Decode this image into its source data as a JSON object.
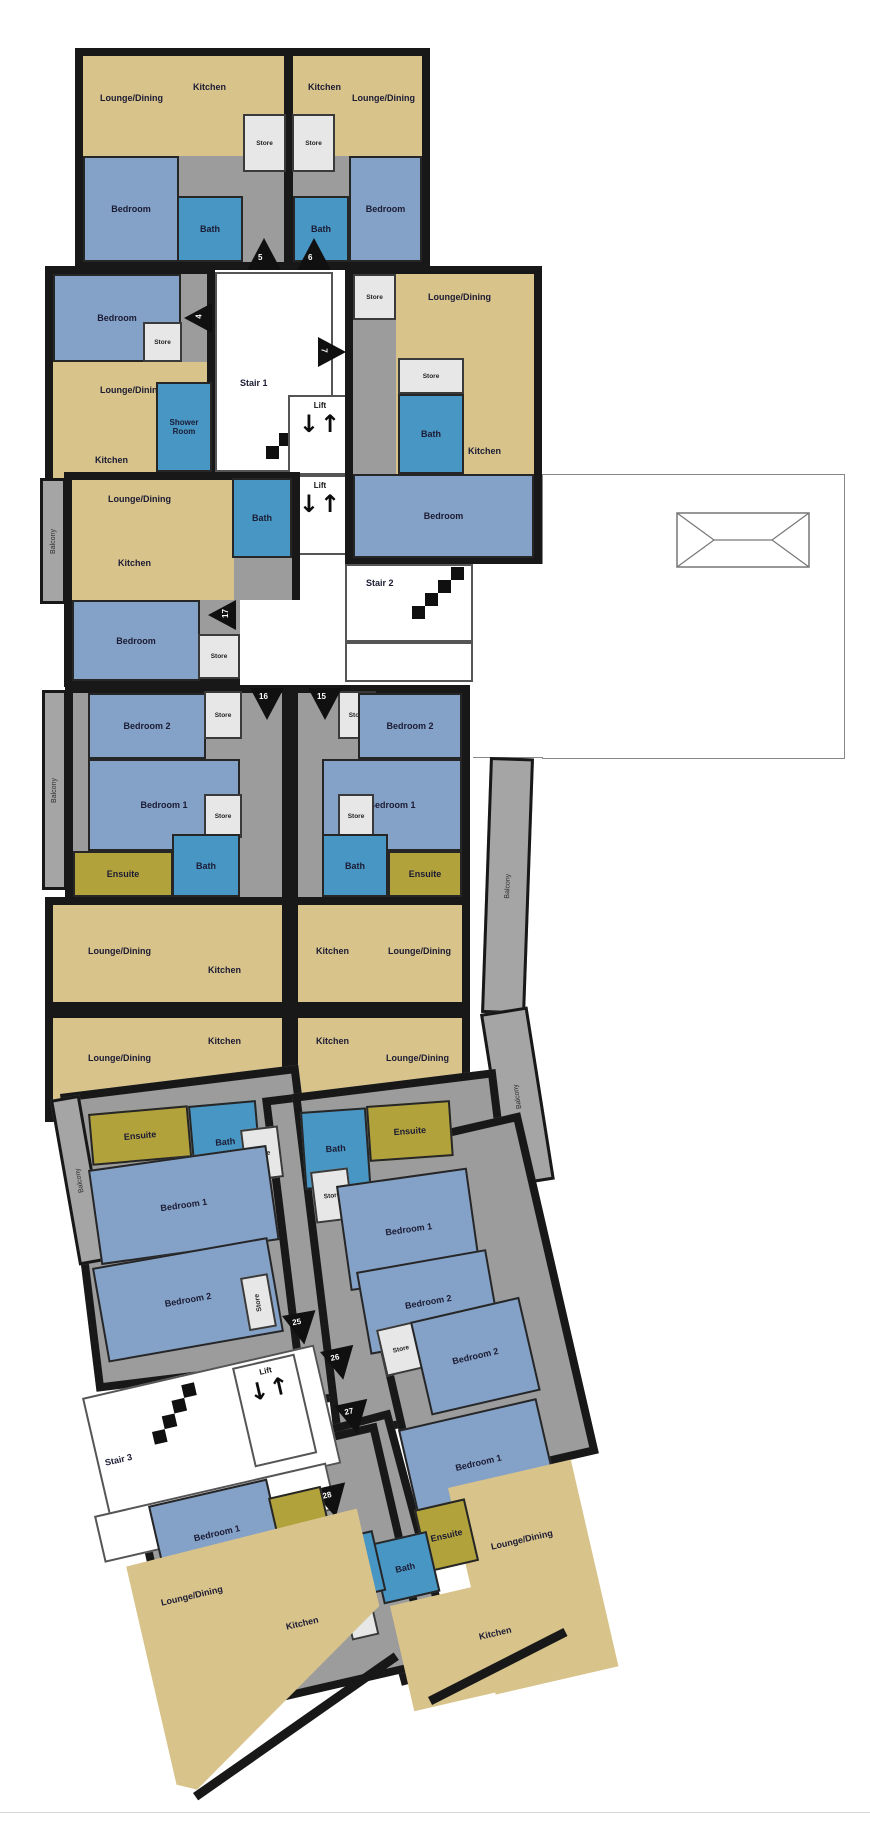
{
  "labels": {
    "lounge_dining": "Lounge/Dining",
    "kitchen": "Kitchen",
    "bedroom": "Bedroom",
    "bedroom1": "Bedroom 1",
    "bedroom2": "Bedroom 2",
    "bath": "Bath",
    "ensuite": "Ensuite",
    "store": "Store",
    "balcony": "Balcony",
    "shower_room": "Shower Room",
    "stair1": "Stair 1",
    "stair2": "Stair 2",
    "stair3": "Stair 3",
    "lift": "Lift",
    "lift_arrows": "↓↑"
  },
  "units": {
    "u4": "4",
    "u5": "5",
    "u6": "6",
    "u7": "7",
    "u15": "15",
    "u16": "16",
    "u17": "17",
    "u25": "25",
    "u26": "26",
    "u27": "27",
    "u28": "28"
  },
  "colors": {
    "wall": "#181818",
    "living": "#d8c38b",
    "bedroom": "#84a1c7",
    "bath": "#4896c4",
    "ensuite": "#b2a23c",
    "circulation": "#9c9c9c",
    "store": "#e7e7e7",
    "stair_area": "#ffffff"
  }
}
